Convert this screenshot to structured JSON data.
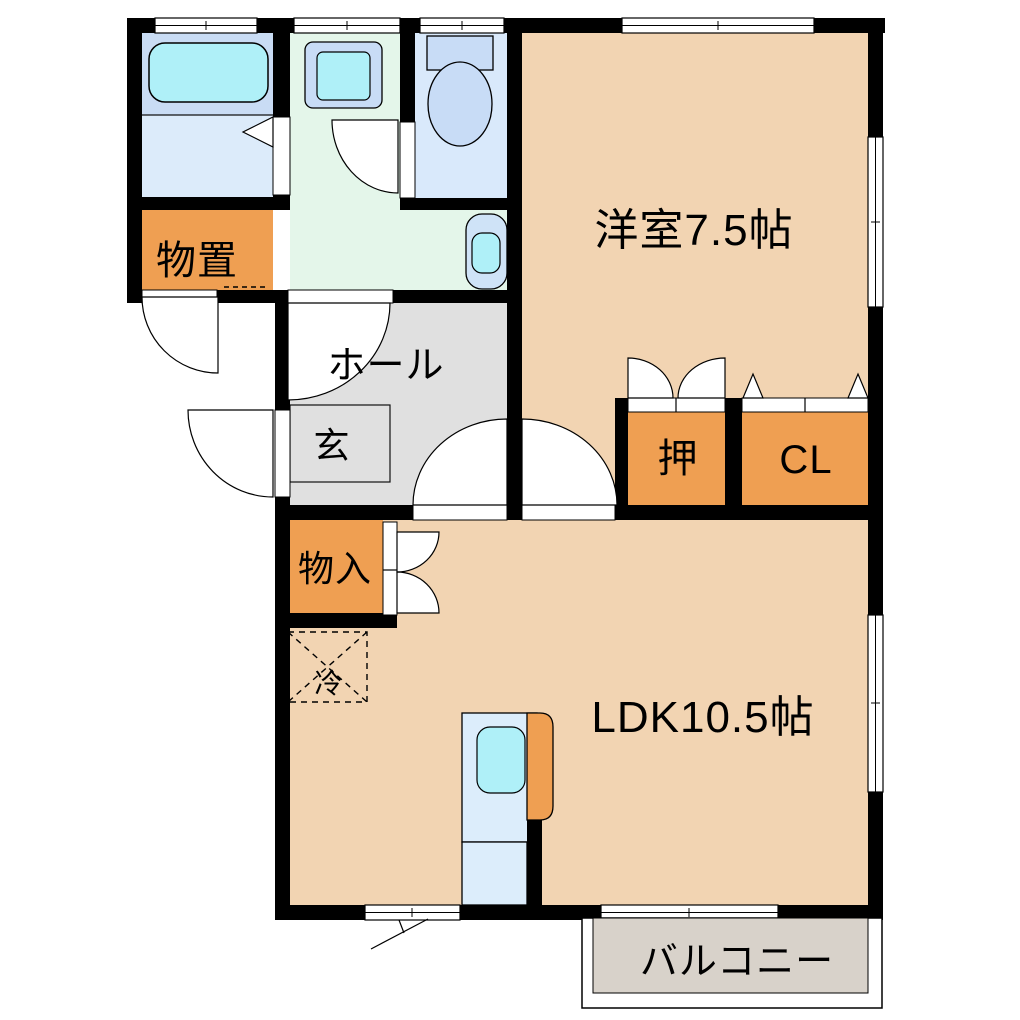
{
  "rooms": {
    "western_room": {
      "label": "洋室7.5帖"
    },
    "ldk": {
      "label": "LDK10.5帖"
    },
    "hall": {
      "label": "ホール"
    },
    "entrance": {
      "label": "玄"
    },
    "storage": {
      "label": "物置"
    },
    "storage_inner": {
      "label": "物入"
    },
    "oshiire": {
      "label": "押"
    },
    "closet": {
      "label": "CL"
    },
    "balcony": {
      "label": "バルコニー"
    },
    "refrigerator_space": {
      "label": "冷"
    }
  },
  "colors": {
    "wall": "#000000",
    "room_peach": "#f2d4b2",
    "closet_orange": "#ef9f52",
    "hall_gray": "#e0e0e0",
    "balcony_gray": "#d8d2ca",
    "washroom_green": "#e4f6ea",
    "bath_blue": "#c9dcf4",
    "bath_blue_light": "#dcebfa",
    "toilet_blue": "#d9e9fb",
    "fixture_blue": "#c8dcf6",
    "water_cyan": "#ace9f2",
    "kitchen_blue": "#dcedfb"
  }
}
